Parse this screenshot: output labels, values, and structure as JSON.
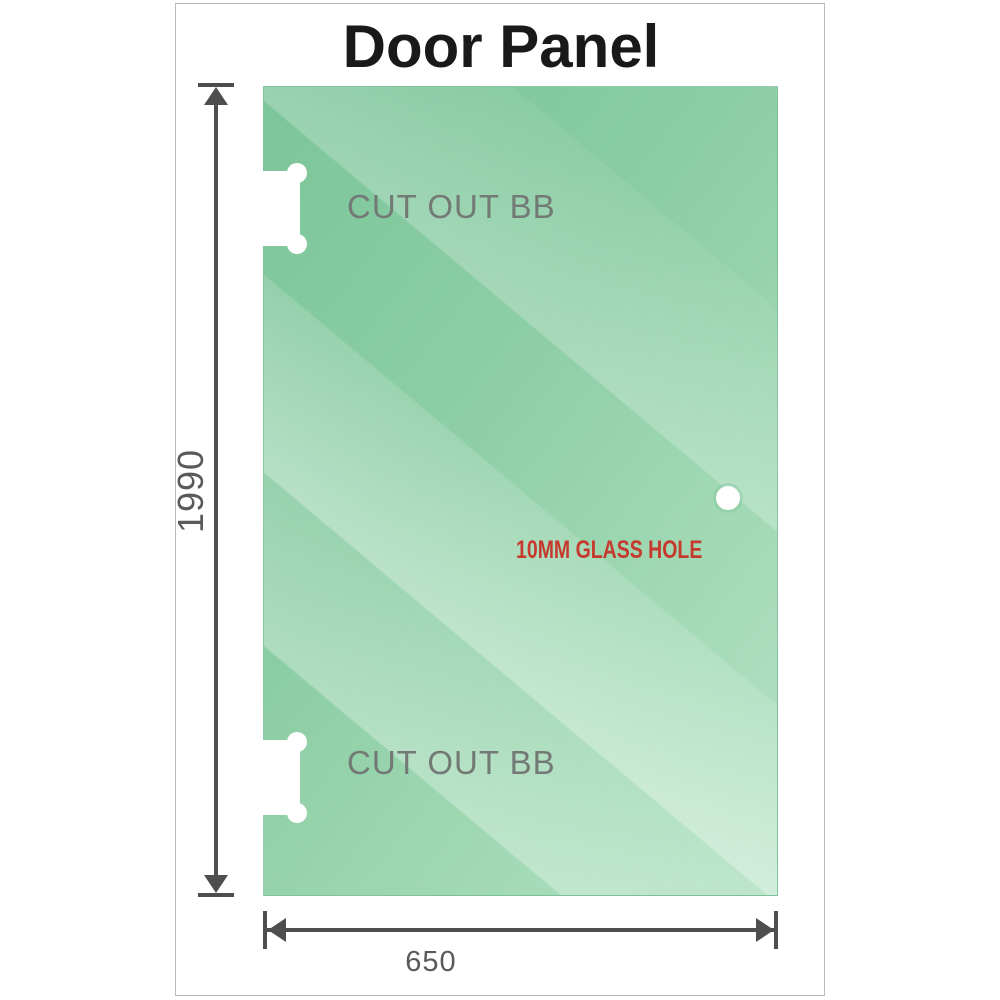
{
  "title": "Door Panel",
  "diagram": {
    "height_dimension": "1990",
    "width_dimension": "650",
    "top_cutout_label": "CUT OUT BB",
    "bottom_cutout_label": "CUT OUT BB",
    "hole_label": "10MM GLASS HOLE"
  },
  "colors": {
    "glass_green_dark": "#79c497",
    "glass_green_light": "#b4e2c5",
    "dimension_gray": "#4e4e4e",
    "cutout_label_gray": "#737a76",
    "hole_label_red": "#c6392e",
    "frame_border_gray": "#b9b9b9",
    "title_color": "#191919"
  }
}
